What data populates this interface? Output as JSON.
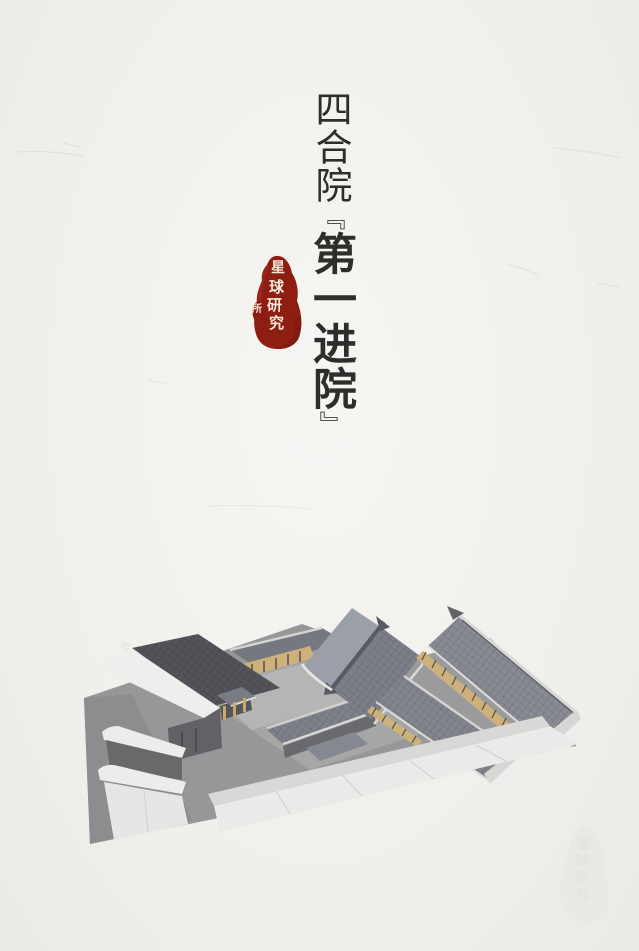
{
  "page": {
    "background_color": "#f1f0ec",
    "text_color": "#2e2d2b"
  },
  "title": {
    "full_text": "四合院『第一进院』",
    "prefix": "四合院",
    "open_bracket": "『",
    "emphasis": "第一进院",
    "close_bracket": "』"
  },
  "seal": {
    "text": "星球研究所",
    "chars": [
      "星",
      "球",
      "研",
      "究",
      "所"
    ],
    "background_color": "#8e1d12",
    "glyph_color": "#f2e9d8"
  },
  "watermark": {
    "text": "星球研究所",
    "color": "#e9e8e3"
  },
  "illustration": {
    "name": "siheyuan-first-courtyard-3d-model",
    "palette": {
      "ground": "#97979a",
      "roof_dark": "#53545a",
      "roof_mid": "#7e828a",
      "roof_light": "#9ba0a8",
      "wall_white": "#eeedeb",
      "wall_shadow": "#67676b",
      "wood": "#cdb07a",
      "courtyard": "#b6b6b7"
    }
  }
}
